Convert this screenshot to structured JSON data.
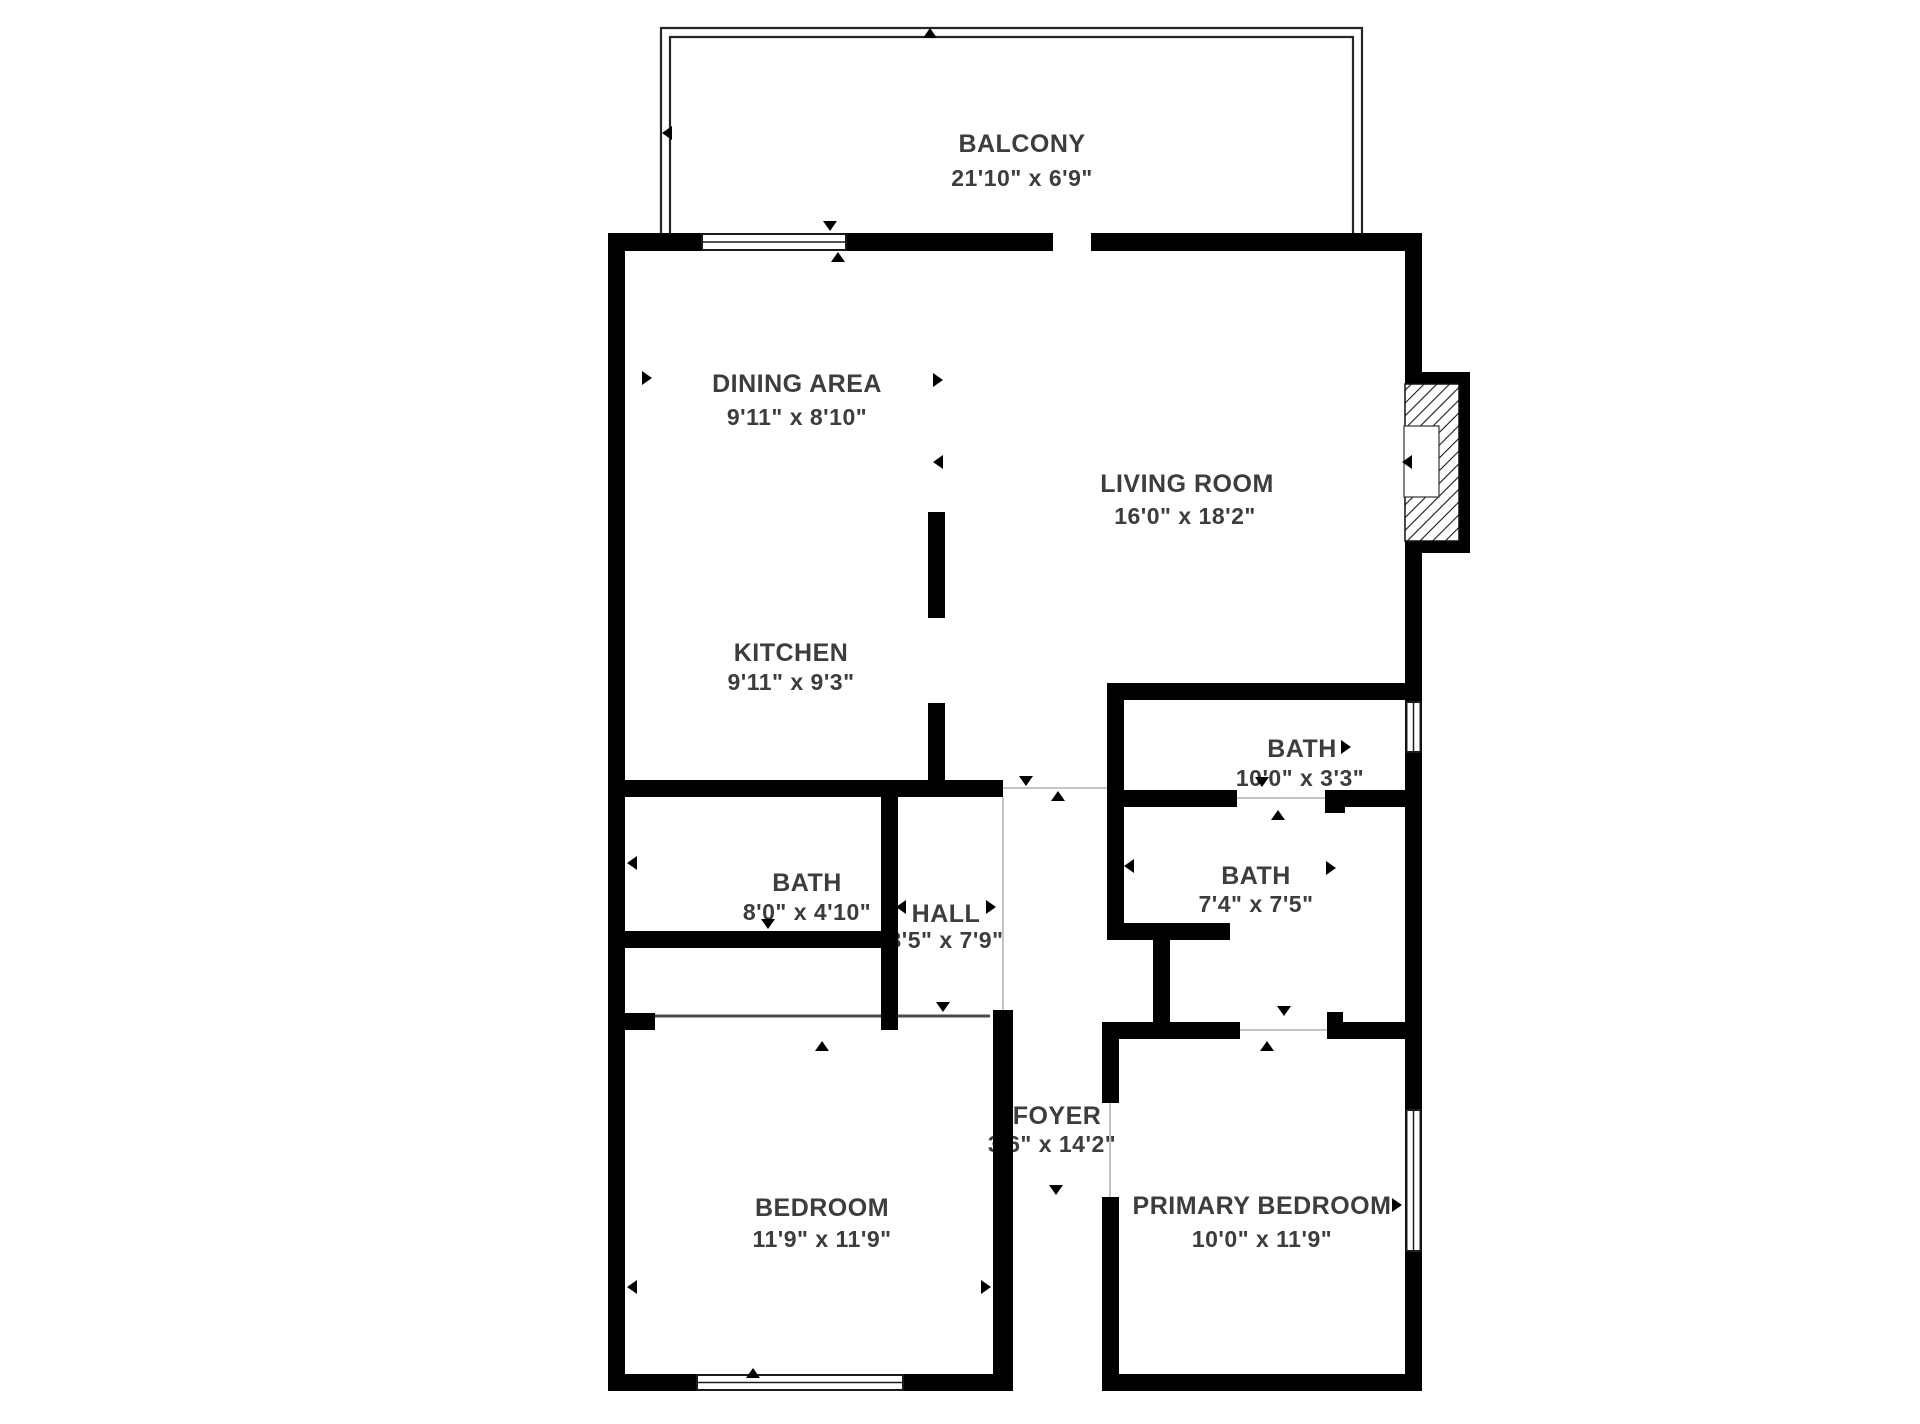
{
  "plan": {
    "type": "floor-plan",
    "wall_color": "#000000",
    "label_color": "#3d3d3d",
    "background": "#ffffff",
    "rooms": {
      "balcony": {
        "name": "BALCONY",
        "dims": "21'10\" x 6'9\""
      },
      "dining": {
        "name": "DINING AREA",
        "dims": "9'11\" x 8'10\""
      },
      "living": {
        "name": "LIVING ROOM",
        "dims": "16'0\" x 18'2\""
      },
      "kitchen": {
        "name": "KITCHEN",
        "dims": "9'11\" x 9'3\""
      },
      "bath_upper": {
        "name": "BATH",
        "dims": "10'0\" x 3'3\""
      },
      "bath_left": {
        "name": "BATH",
        "dims": "8'0\" x 4'10\""
      },
      "hall": {
        "name": "HALL",
        "dims": "3'5\" x 7'9\""
      },
      "bath_right": {
        "name": "BATH",
        "dims": "7'4\" x 7'5\""
      },
      "foyer": {
        "name": "FOYER",
        "dims": "3'6\" x 14'2\""
      },
      "bedroom": {
        "name": "BEDROOM",
        "dims": "11'9\" x 11'9\""
      },
      "primary_bedroom": {
        "name": "PRIMARY BEDROOM",
        "dims": "10'0\" x 11'9\""
      }
    }
  }
}
